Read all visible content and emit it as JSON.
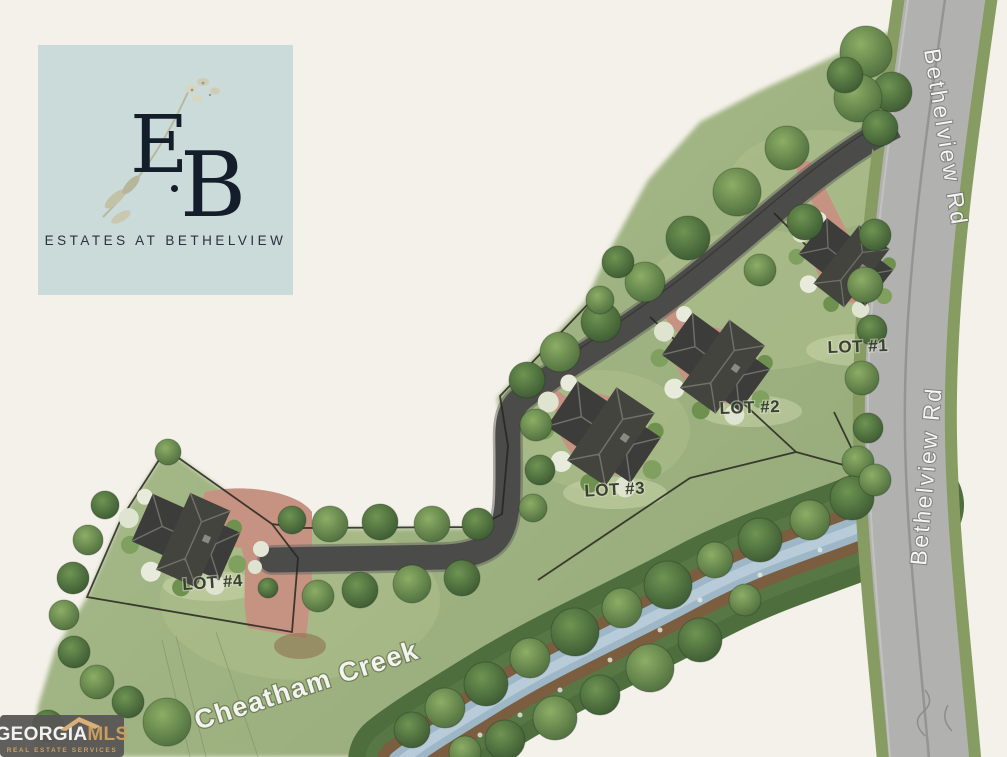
{
  "logo": {
    "monogram_e": "E",
    "monogram_b": "B",
    "name": "ESTATES AT BETHELVIEW"
  },
  "site_plan": {
    "road_labels": {
      "top": "Bethelview Rd",
      "bottom": "Bethelview Rd"
    },
    "creek_label": "Cheatham Creek",
    "lots": [
      {
        "label": "LOT #1"
      },
      {
        "label": "LOT #2"
      },
      {
        "label": "LOT #3"
      },
      {
        "label": "LOT #4"
      }
    ]
  },
  "watermark": {
    "brand": "GEORGIA",
    "suffix": "MLS",
    "tagline": "REAL ESTATE SERVICES"
  },
  "colors": {
    "background": "#f4f1ea",
    "logo_background": "#cbdbda",
    "logo_text": "#141e2b",
    "grass": "#a3b685",
    "major_road": "#b1b1af",
    "road_verge": "#879c62",
    "minor_road": "#4b4b49",
    "driveway": "#c69382",
    "creek_water": "#9db7c6",
    "creek_bank": "#7b5d40",
    "vegetation": "#4f6e3e",
    "watermark_background": "#585654",
    "watermark_gold": "#c99c5f"
  }
}
